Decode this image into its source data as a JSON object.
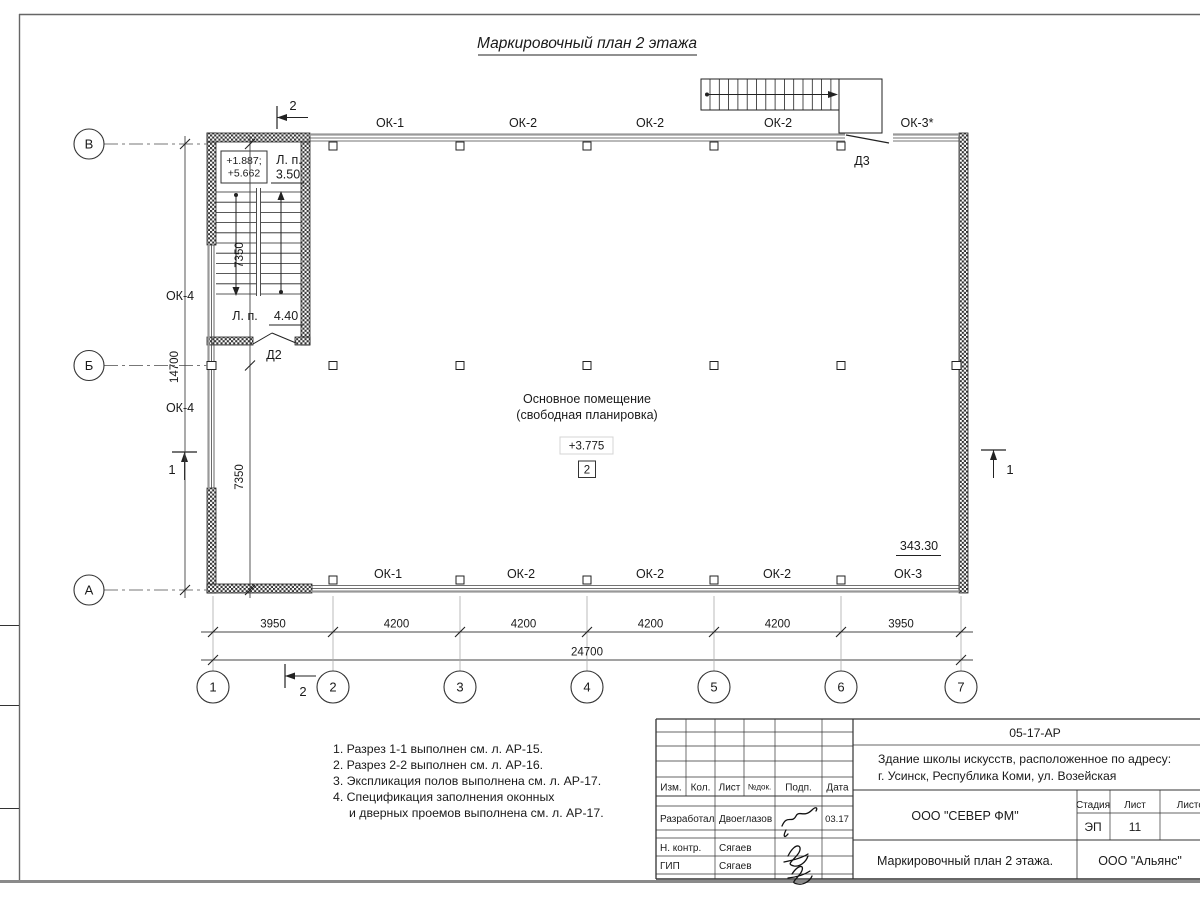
{
  "sheet": {
    "title": "Маркировочный план 2 этажа"
  },
  "plan": {
    "axes": {
      "cols": [
        "1",
        "2",
        "3",
        "4",
        "5",
        "6",
        "7"
      ],
      "rows": [
        "В",
        "Б",
        "А"
      ]
    },
    "windows": {
      "top": [
        "ОК-1",
        "ОК-2",
        "ОК-2",
        "ОК-2",
        "ОК-3*"
      ],
      "bottom": [
        "ОК-1",
        "ОК-2",
        "ОК-2",
        "ОК-2",
        "ОК-3"
      ],
      "left": [
        "ОК-4",
        "ОК-4"
      ]
    },
    "doors": {
      "d2": "Д2",
      "d3": "Д3"
    },
    "stair": {
      "elev_line1": "+1.887;",
      "elev_line2": "+5.662",
      "landing_abbr_top": "Л. п.",
      "landing_width_top": "3.50",
      "landing_abbr_bottom": "Л. п.",
      "landing_width_bottom": "4.40"
    },
    "room": {
      "name_line1": "Основное помещение",
      "name_line2": "(свободная планировка)",
      "elevation": "+3.775",
      "room_number": "2",
      "area": "343.30"
    },
    "dims": {
      "bottom": [
        "3950",
        "4200",
        "4200",
        "4200",
        "4200",
        "3950"
      ],
      "bottom_total": "24700",
      "left": [
        "7350",
        "7350"
      ],
      "left_total": "14700"
    },
    "sections": {
      "mark1": "1",
      "mark2": "2"
    }
  },
  "notes": {
    "line1": "1. Разрез 1-1 выполнен см. л. АР-15.",
    "line2": "2. Разрез 2-2 выполнен см. л. АР-16.",
    "line3": "3. Экспликация полов выполнена см. л. АР-17.",
    "line4": "4. Спецификация заполнения оконных",
    "line5": "и дверных проемов выполнена см. л. АР-17."
  },
  "titleblock": {
    "doc_code": "05-17-АР",
    "object_line1": "Здание школы искусств, расположенное по адресу:",
    "object_line2": "г. Усинск, Республика Коми, ул. Возейская",
    "cols": {
      "izm": "Изм.",
      "kol": "Кол.",
      "list": "Лист",
      "ndok": "№док.",
      "podp": "Подп.",
      "data": "Дата"
    },
    "row_developed": {
      "role": "Разработал",
      "name": "Двоеглазов",
      "date": "03.17"
    },
    "row_ncontr": {
      "role": "Н. контр.",
      "name": "Сягаев"
    },
    "row_gip": {
      "role": "ГИП",
      "name": "Сягаев"
    },
    "company": "ООО \"СЕВЕР ФМ\"",
    "sheet_caption": "Маркировочный план 2 этажа.",
    "contractor": "ООО \"Альянс\"",
    "stage_label": "Стадия",
    "list_label": "Лист",
    "listov_label": "Листов",
    "stage_value": "ЭП",
    "list_value": "11"
  }
}
